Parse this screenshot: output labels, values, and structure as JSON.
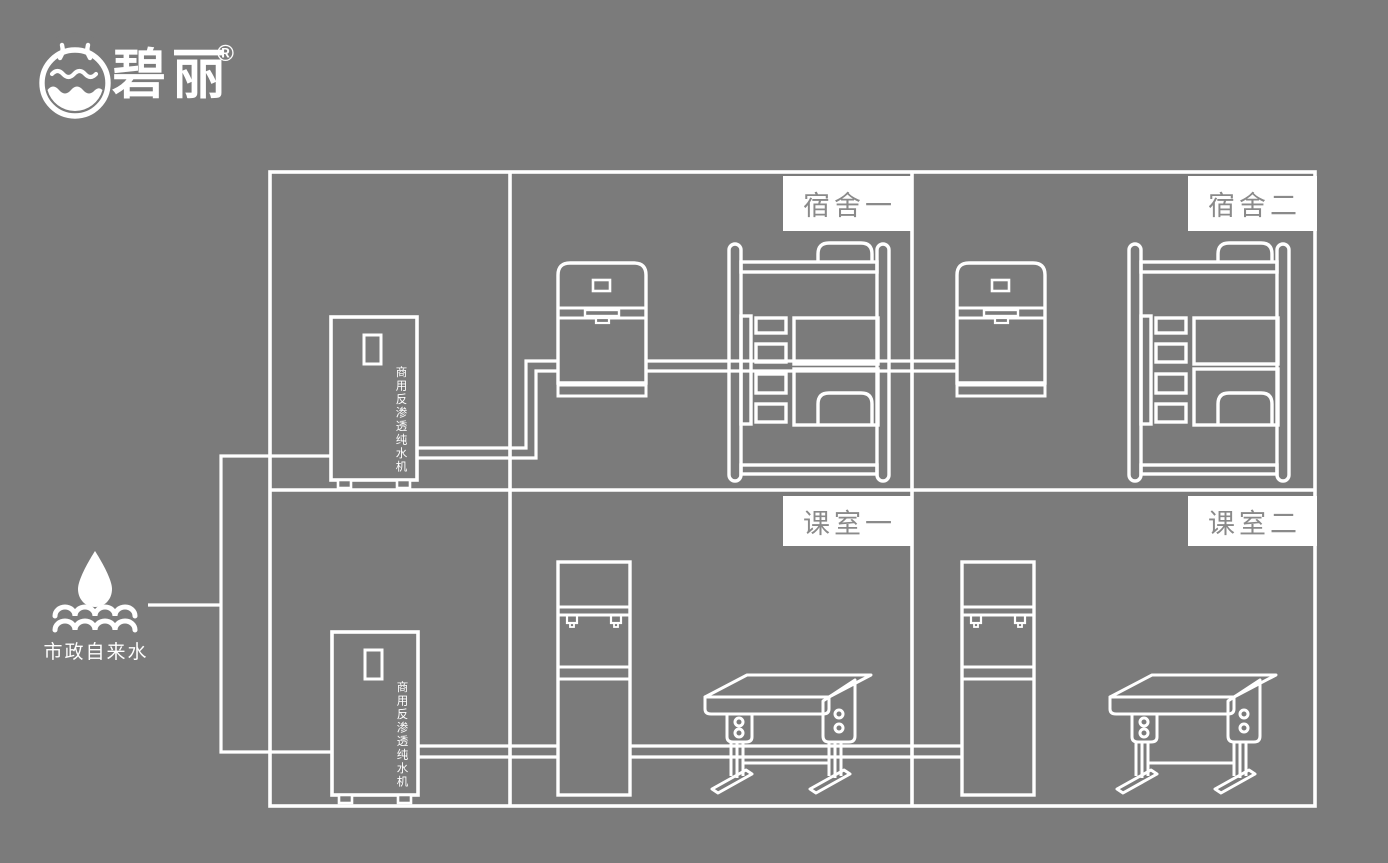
{
  "colors": {
    "background": "#7b7b7b",
    "line": "#ffffff",
    "label_box_bg": "#ffffff",
    "label_text": "#8a8a8a"
  },
  "logo": {
    "brand": "碧丽",
    "registered_mark": "®"
  },
  "water_source": {
    "label": "市政自来水"
  },
  "machines": {
    "ro_machine_label": "商用反渗透纯水机"
  },
  "rooms": [
    {
      "id": "dorm-1",
      "label": "宿舍一"
    },
    {
      "id": "dorm-2",
      "label": "宿舍二"
    },
    {
      "id": "classroom-1",
      "label": "课室一"
    },
    {
      "id": "classroom-2",
      "label": "课室二"
    }
  ],
  "icons": {
    "brand_emblem": "water-cup-emblem",
    "source": "water-drop-over-waves"
  }
}
